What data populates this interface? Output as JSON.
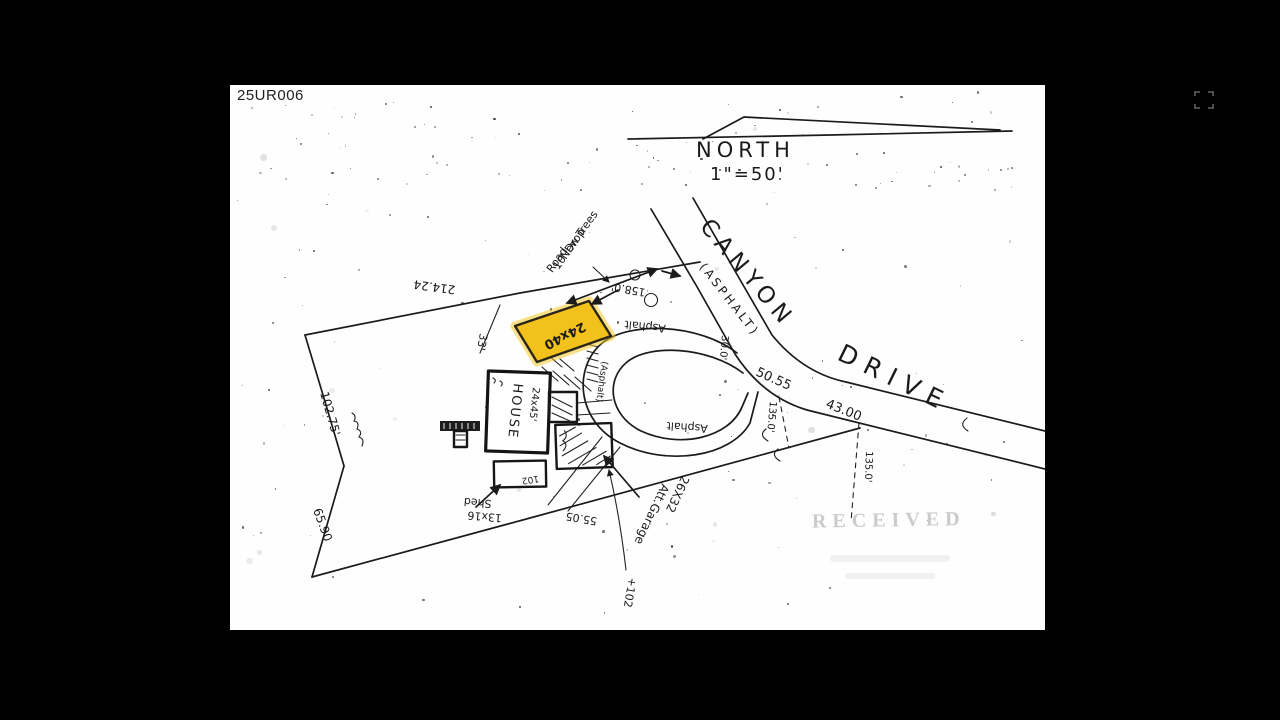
{
  "viewer": {
    "expand_icon": "expand"
  },
  "doc": {
    "id": "25UR006",
    "north_label": "NORTH",
    "scale": "1\"=50'",
    "road": {
      "canyon": "CANYON",
      "asphalt": "(ASPHALT)",
      "drive": "DRIVE"
    },
    "highlight": {
      "label": "24x40",
      "color": "#f5c518"
    },
    "house": {
      "label": "HOUSE",
      "dims": "24x45'"
    },
    "garage": {
      "dims": "26X32",
      "label": "Att.Garage"
    },
    "shed": {
      "label": "Shed",
      "dims": "13x16",
      "area": "102"
    },
    "trees": {
      "line1": "New Trees",
      "line2": "10' Drop",
      "line3": "Road"
    },
    "asphalt": {
      "a": "Asphalt",
      "b": "Asphalt",
      "c": "(Asphalt)"
    },
    "dims": {
      "top": "214.24",
      "setback": "33'",
      "left_upper": "102.75'",
      "left_lower": "65.90",
      "bottom": "55.05",
      "road_a": "50.55",
      "road_b": "43.00",
      "depth_a": "135.0'",
      "depth_b": "135.0'",
      "road_width": "30.0'",
      "frontage": "158.0'",
      "bench": "+102"
    },
    "stamp": "RECEIVED"
  }
}
